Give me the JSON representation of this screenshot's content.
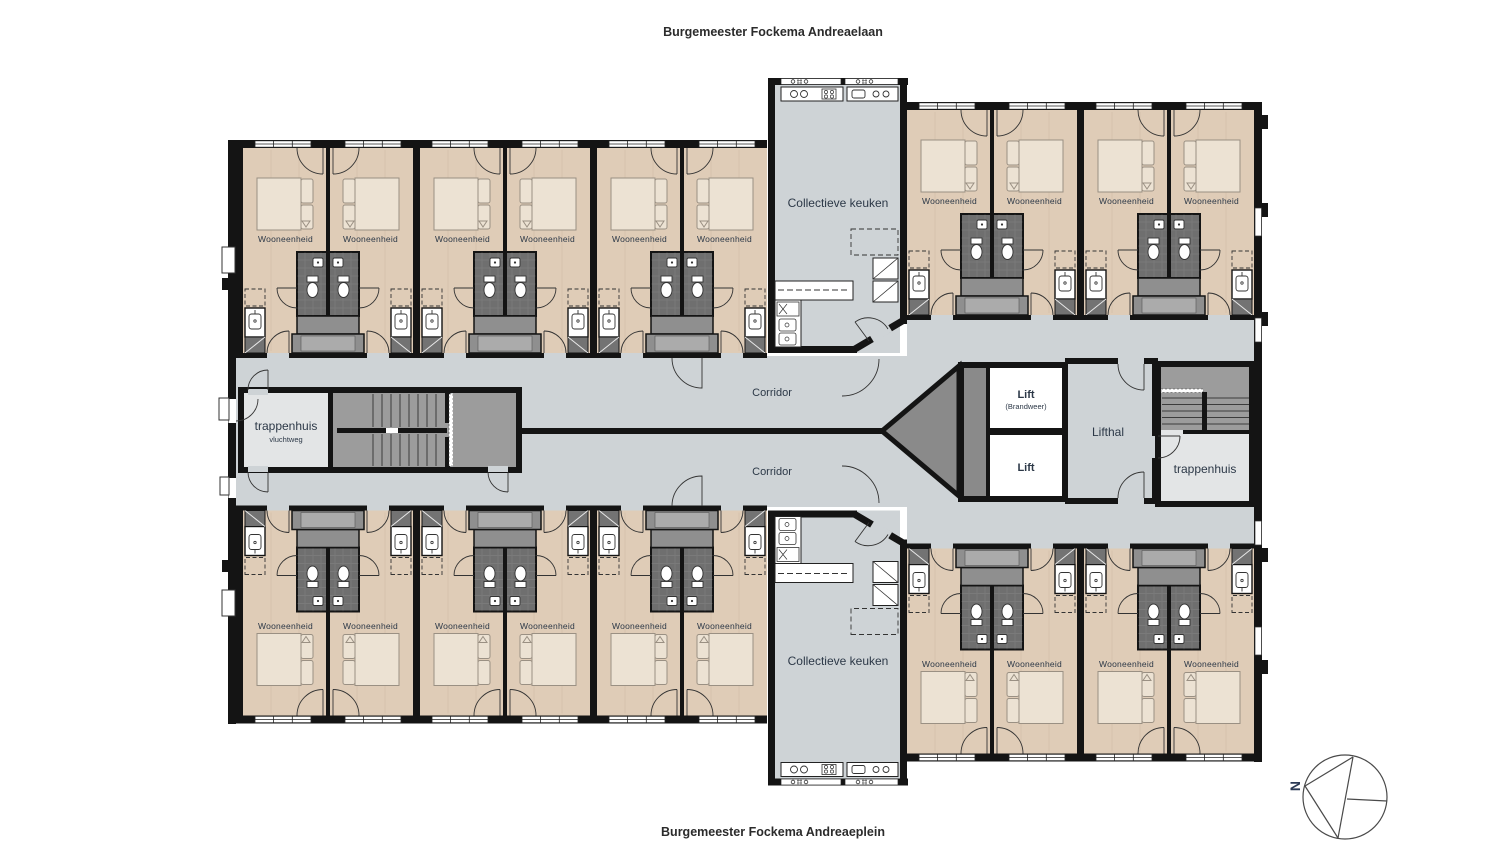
{
  "streets": {
    "top": "Burgemeester Fockema Andreaelaan",
    "bottom": "Burgemeester Fockema Andreaeplein"
  },
  "rooms": {
    "unit": "Wooneenheid",
    "kitchen": "Collectieve keuken",
    "corridor": "Corridor",
    "stairwell_escape": {
      "name": "trappenhuis",
      "sub": "vluchtweg"
    },
    "stairwell": "trappenhuis",
    "lift_hall": "Lifthal",
    "lift_fire": {
      "name": "Lift",
      "sub": "(Brandweer)"
    },
    "lift": "Lift"
  },
  "compass": {
    "north": "N"
  },
  "palette": {
    "wall": "#141414",
    "corridor_floor": "#ced3d6",
    "unit_floor": "#dfccb7",
    "stair_gray": "#9c9c9c",
    "shaft_gray": "#8a8a8a",
    "bathroom_pod": "#6f6f6f",
    "stair_room": "#e3e5e6",
    "bed": "#ece2d3",
    "fixture": "#ffffff",
    "label_text": "#2c3847",
    "street_text": "#2b2b2b"
  }
}
